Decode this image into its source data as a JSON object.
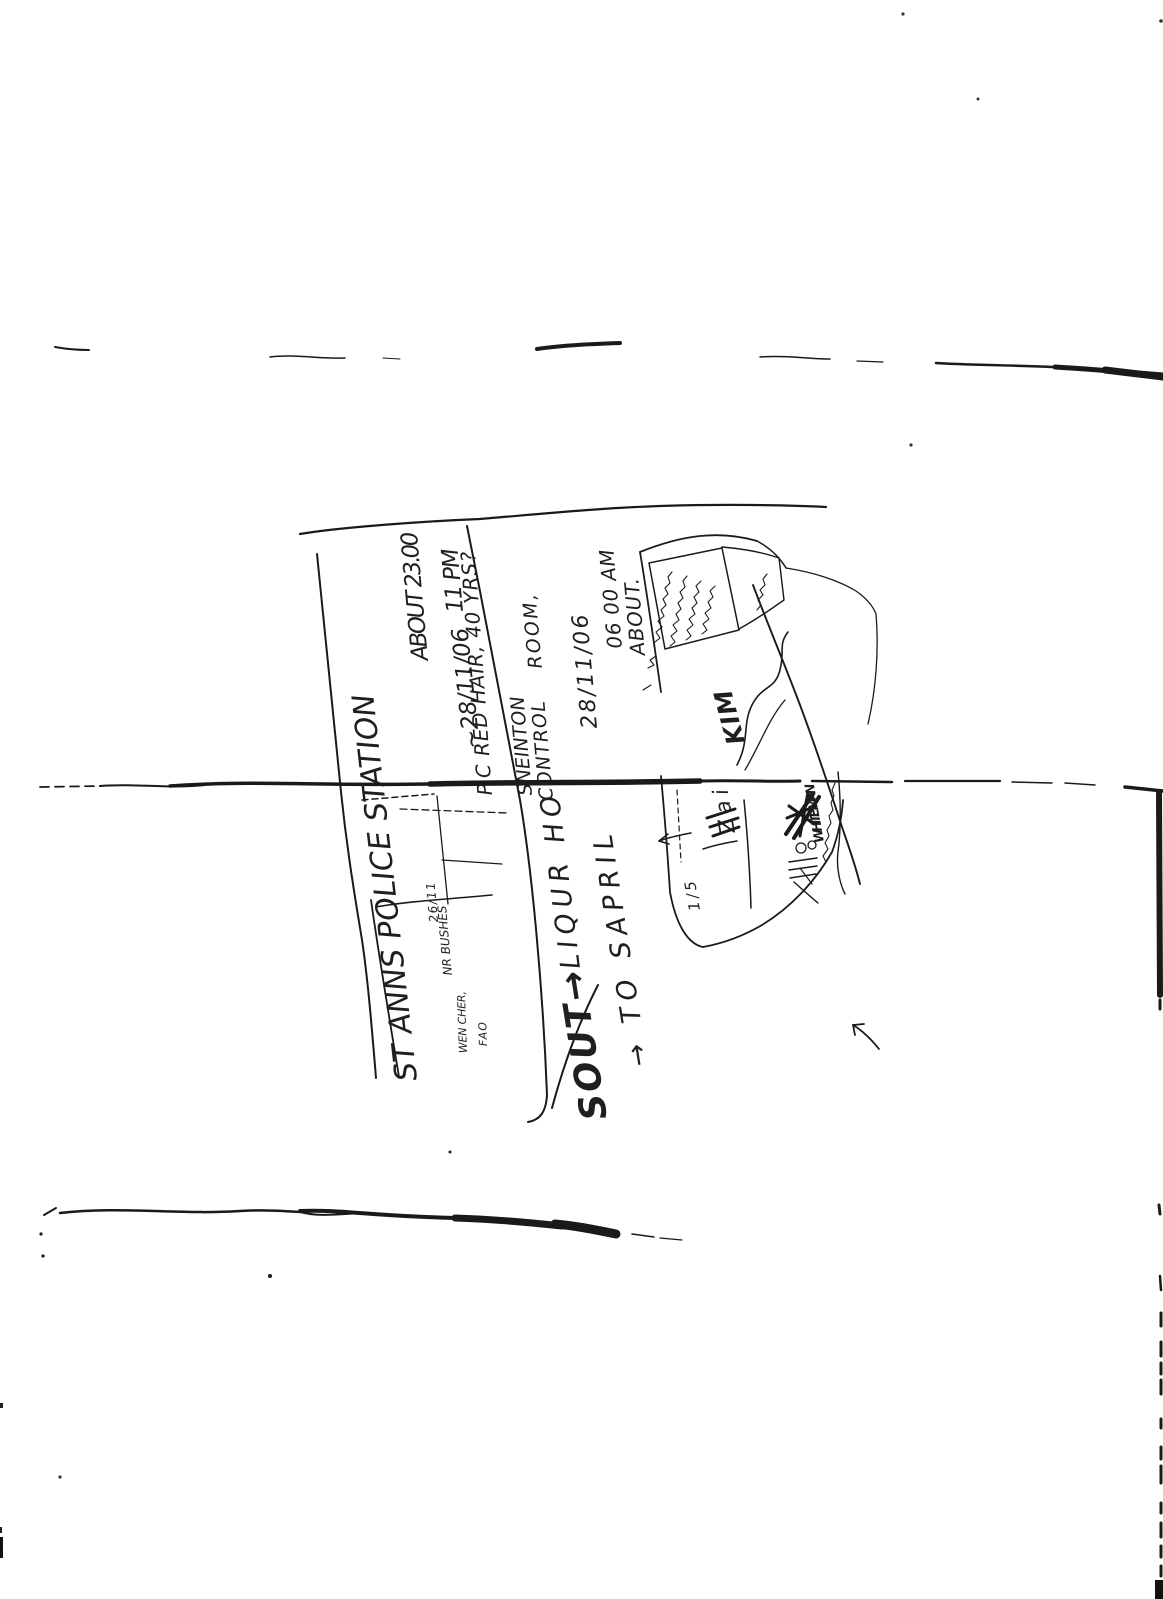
{
  "page": {
    "background": "#ffffff",
    "ink_color": "#1a1a1a",
    "description": "Photocopied scan of a folded sheet bearing rotated handwritten notes and a rough sketch map"
  },
  "handwriting": {
    "station_line": "ST ANNS POLICE STATION",
    "time_main": "ABOUT 23.00",
    "time_alt": "11 PM",
    "date_main": "~28/11/06",
    "officer_line": "P.C  RED HAIR, 40 YRS?",
    "control_word1": "SNEINTON",
    "control_word2": "CONTROL",
    "control_word3": "ROOM,",
    "control_date": "28/11/06",
    "control_time": "06 00 AM",
    "control_about": "ABOUT.",
    "scrawl_sout": "SOUT→",
    "scrawl_liqur": "LIQUR HO",
    "scrawl_sapril": "→ TO SAPRIL",
    "note_bushes": "NR BUSHES",
    "note_2611": "26/11",
    "note_wencher": "WEN CHER,",
    "note_fao": "FAO",
    "map_kim": "KIM",
    "map_zai": "Zai",
    "map_fraction": "1/5",
    "map_whiteman": "WHITE MAN"
  },
  "illegible": {
    "box_note": "illegible scrawled note lines inside sketch box",
    "signature_note": "illegible cursive scrawl",
    "thin_note": "illegible thin scrawled line",
    "small_marks": "illegible small marks"
  }
}
